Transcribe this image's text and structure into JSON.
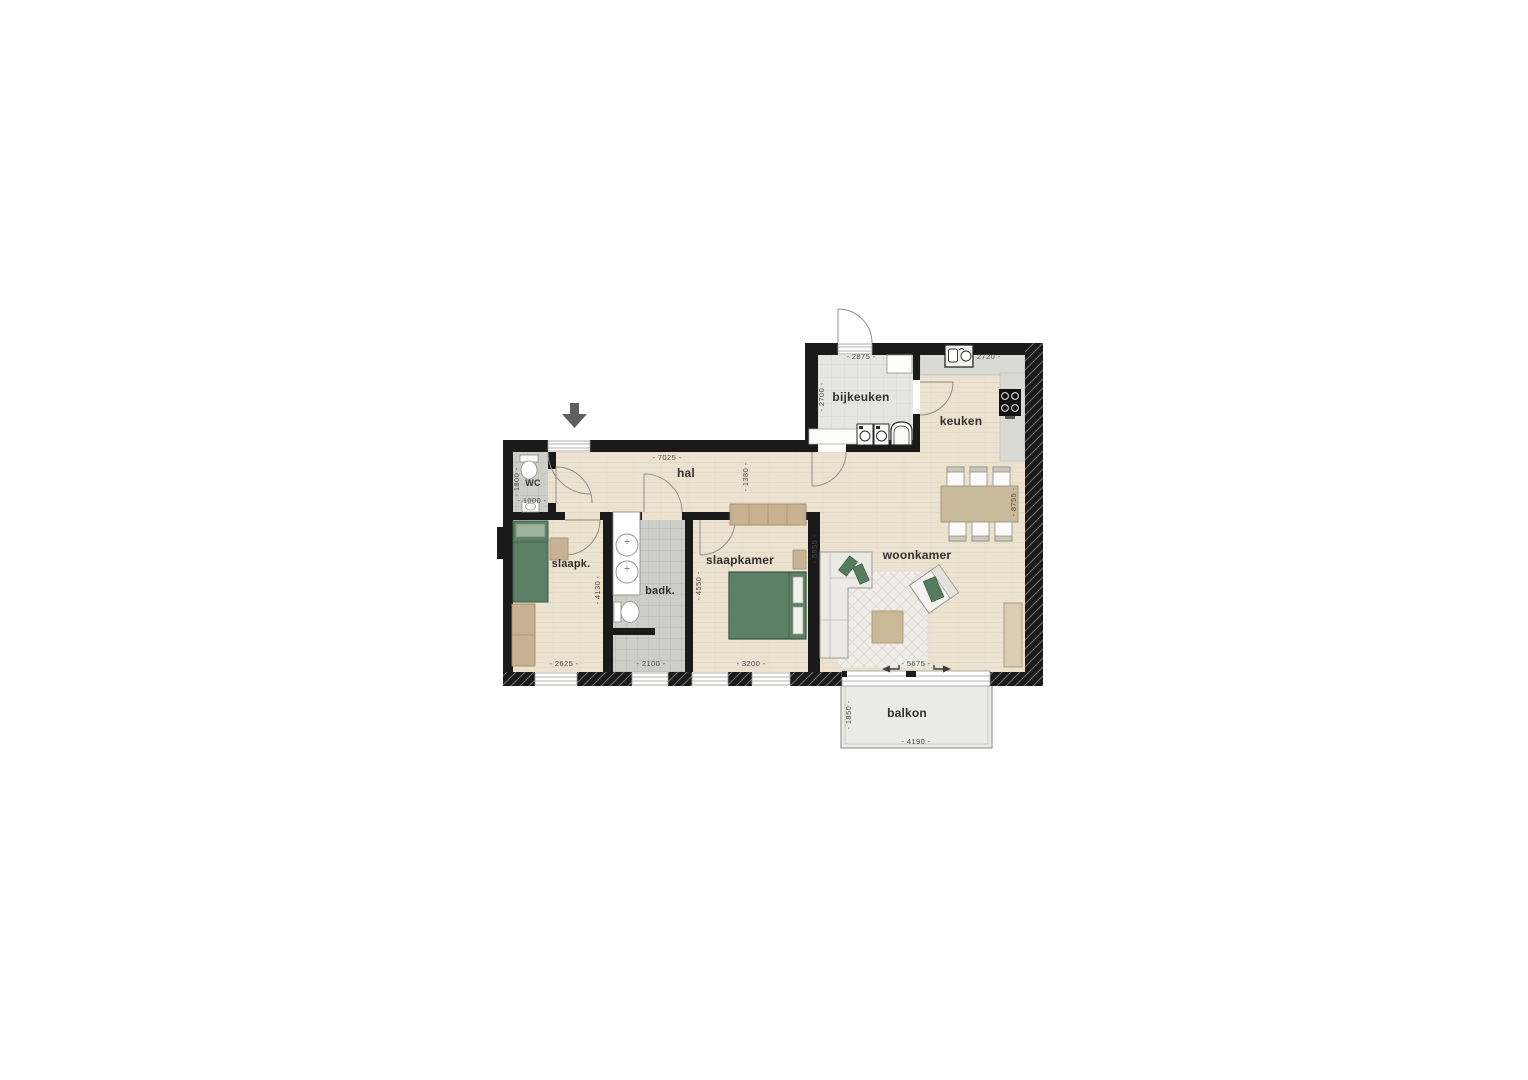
{
  "floorplan": {
    "rooms": {
      "wc": {
        "label": "WC"
      },
      "hal": {
        "label": "hal"
      },
      "slaapk": {
        "label": "slaapk."
      },
      "badk": {
        "label": "badk."
      },
      "slaapkamer": {
        "label": "slaapkamer"
      },
      "woonkamer": {
        "label": "woonkamer"
      },
      "bijkeuken": {
        "label": "bijkeuken"
      },
      "keuken": {
        "label": "keuken"
      },
      "balkon": {
        "label": "balkon"
      }
    },
    "dims": {
      "bijkeuken_width": "- 2875 -",
      "bijkeuken_depth": "- 2700 -",
      "keuken_width": "- 2720 -",
      "hal_width": "- 7025 -",
      "hal_depth": "- 1380 -",
      "wc_depth": "- 1800 -",
      "wc_width": "- 1000 -",
      "slaapk_depth": "- 4130 -",
      "slaapk_width": "- 2625 -",
      "badk_width": "- 2100 -",
      "slaapkamer_depth": "- 4550 -",
      "slaapkamer_width": "- 3200 -",
      "woonkamer_depth": "- 5955 -",
      "woonkamer_width": "- 5675 -",
      "right_side_depth": "- 8755 -",
      "balkon_depth": "- 1850 -",
      "balkon_width": "- 4190 -"
    },
    "icons": {
      "entrance_arrow": "down-arrow"
    },
    "colors": {
      "wall": "#1a1a1a",
      "wood_floor": "#ece2d0",
      "tile_floor": "#cdcdc9",
      "bijkeuken_floor": "#e5e5e2",
      "counter": "#d9d9d5",
      "furniture_green": "#5c8066",
      "furniture_tan": "#c9b291",
      "balkon_floor": "#eaeae8",
      "dim_text": "#4a4a4a",
      "label_text": "#2f2f2f"
    }
  }
}
